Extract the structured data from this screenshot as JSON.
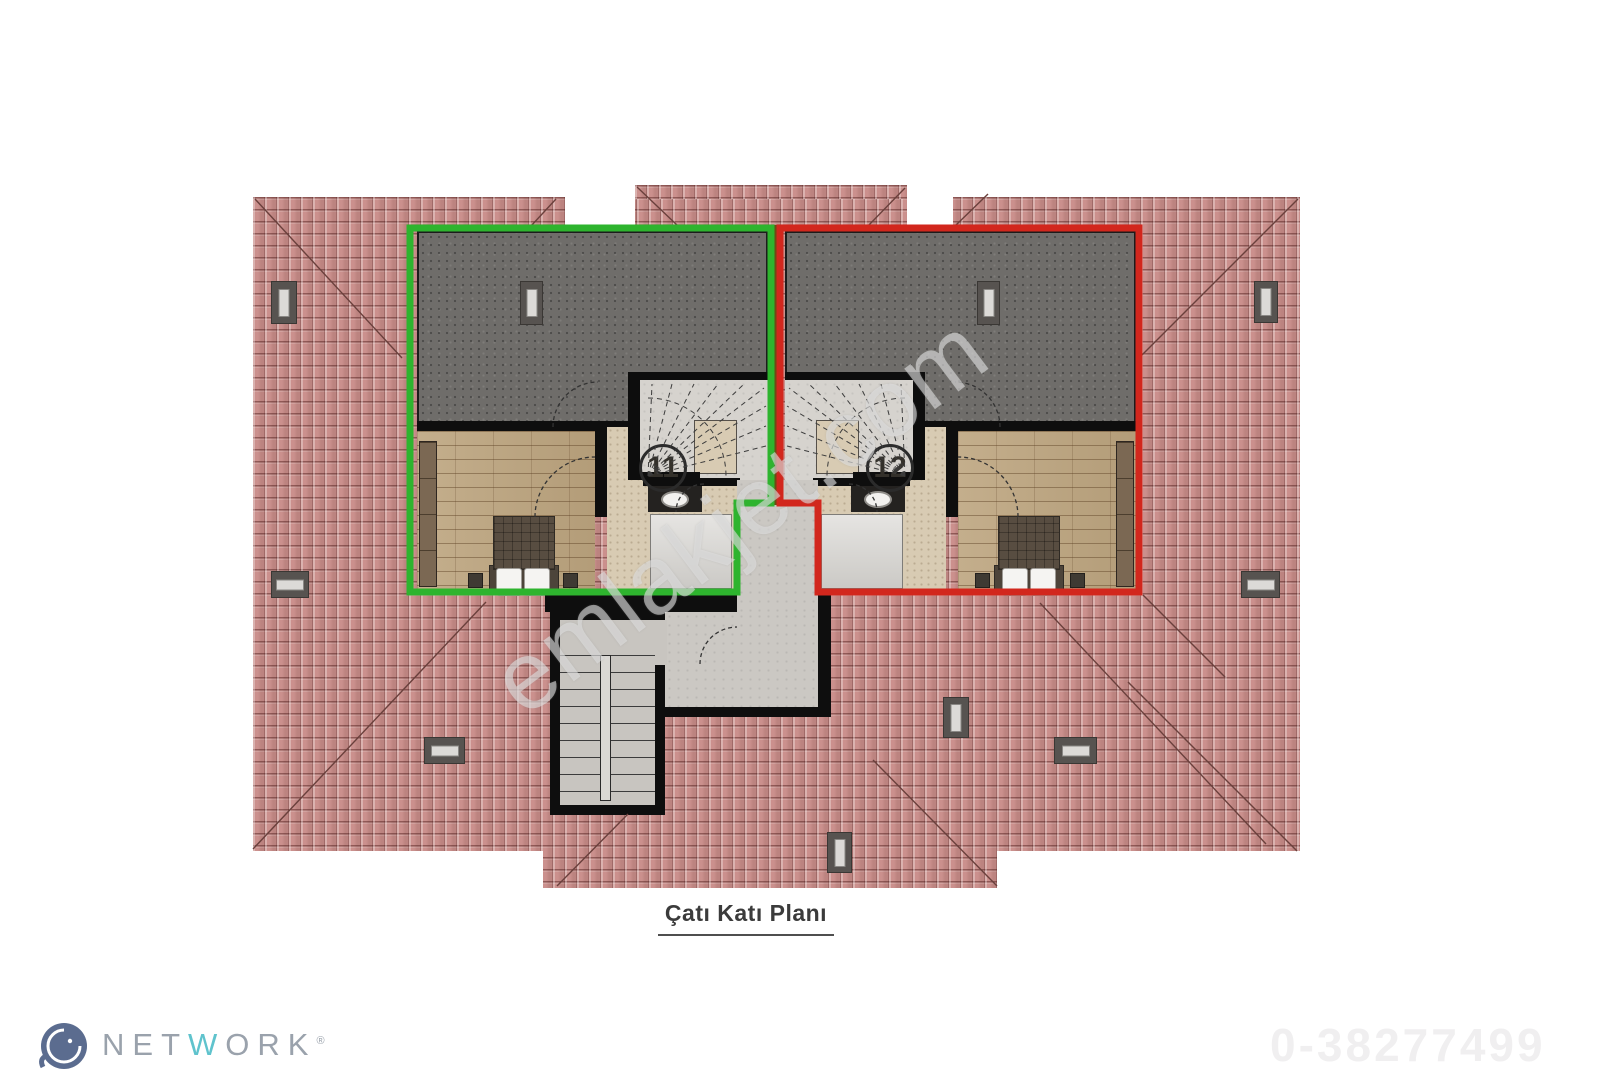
{
  "plan": {
    "title": "Çatı Katı Planı",
    "units": [
      {
        "number": "11",
        "outline_color": "#2eb42e"
      },
      {
        "number": "12",
        "outline_color": "#d2271d"
      }
    ]
  },
  "watermark": {
    "text": "emlakjet.com"
  },
  "footer": {
    "brand": {
      "letters": [
        "N",
        "E",
        "T",
        "W",
        "O",
        "R",
        "K"
      ],
      "registered": "®",
      "icon": "elephant-icon",
      "accent_color": "#5fc3cd",
      "text_color": "#9aa2ac"
    },
    "reference": "0-38277499"
  },
  "colors": {
    "roof_tile": "#cb908d",
    "terrace": "#6f6d6a",
    "wood_floor": "#bda57f",
    "hall_floor": "#d8cbb3",
    "unit11_outline": "#2eb42e",
    "unit12_outline": "#d2271d",
    "walls": "#0e0e0e"
  }
}
